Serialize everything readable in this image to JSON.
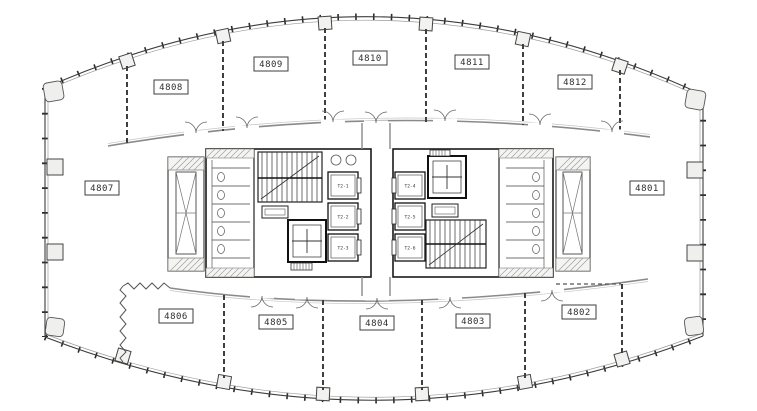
{
  "rooms": [
    {
      "label": "4801"
    },
    {
      "label": "4802"
    },
    {
      "label": "4803"
    },
    {
      "label": "4804"
    },
    {
      "label": "4805"
    },
    {
      "label": "4806"
    },
    {
      "label": "4807"
    },
    {
      "label": "4808"
    },
    {
      "label": "4809"
    },
    {
      "label": "4810"
    },
    {
      "label": "4811"
    },
    {
      "label": "4812"
    }
  ],
  "core": {
    "elevator_cabins": [
      "T2-1",
      "T2-2",
      "T2-3",
      "T2-4",
      "T2-5",
      "T2-6"
    ]
  },
  "colors": {
    "linework": "#3c3c3c",
    "heavy_wall": "#161616",
    "glazing_line": "#9b9b9b",
    "corridor_wall": "#8a8a8a",
    "hatch_line": "#9c9c9c",
    "column_fill": "#efefed",
    "background": "#ffffff"
  },
  "icons": {
    "double_swing_door": "two quarter-circle arcs",
    "elevator_crosshair": "+",
    "shaft_brace": "X",
    "stair_run": "parallel treads with diagonal cut line"
  }
}
